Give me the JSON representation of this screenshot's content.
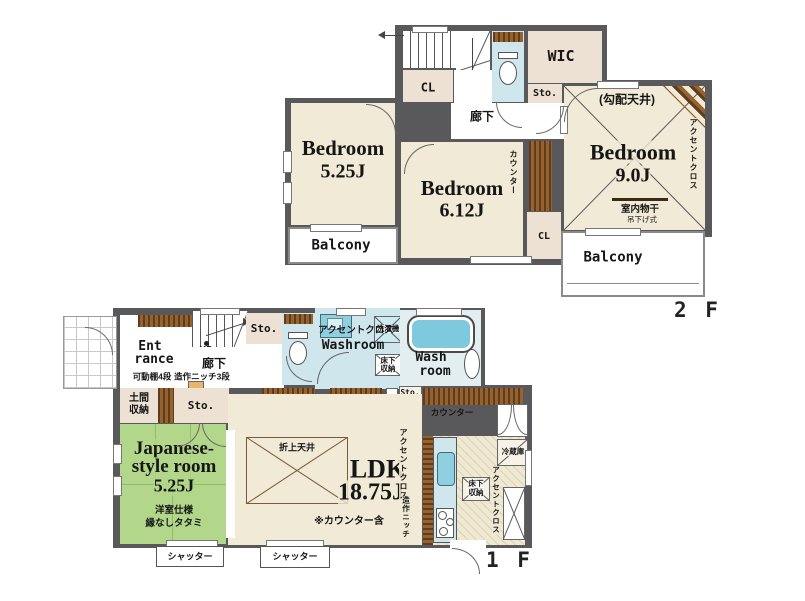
{
  "floor2": {
    "label": "2 F",
    "bed1_name": "Bedroom",
    "bed1_size": "5.25J",
    "bed2_name": "Bedroom",
    "bed2_size": "6.12J",
    "bed3_name": "Bedroom",
    "bed3_size": "9.0J",
    "sloped_ceiling": "(勾配天井)",
    "accent_cloth": "アクセントクロス",
    "indoor_drying": "室内物干",
    "hanging_type": "吊下げ式",
    "wic": "WIC",
    "sto": "Sto.",
    "cl_upper": "CL",
    "cl_lower": "CL",
    "corridor": "廊下",
    "counter": "カウンター",
    "dn": "DN",
    "balcony_left": "Balcony",
    "balcony_right": "Balcony"
  },
  "floor1": {
    "label": "1 F",
    "entrance_l1": "Ent",
    "entrance_l2": "rance",
    "up": "UP",
    "corridor": "廊下",
    "shelf_a": "可動棚4段",
    "niche_a": "造作ニッチ3段",
    "doma_l1": "土間",
    "doma_l2": "収納",
    "sto_top": "Sto.",
    "sto_mid": "Sto.",
    "sto_small": "Sto.",
    "counter_left": "カウンター",
    "counter_right": "カウンター",
    "accent_wash": "アクセントクロス",
    "washroom": "Washroom",
    "washer": "洗濯機",
    "underfloor_l1": "床下",
    "underfloor_l2": "収納",
    "bath_l1": "Wash",
    "bath_l2": "room",
    "shelf_b": "可動棚4段",
    "ps": "PS",
    "japanese_l1": "Japanese-",
    "japanese_l2": "style room",
    "japanese_size": "5.25J",
    "tatami_note1": "洋室仕様",
    "tatami_note2": "縁なしタタミ",
    "coffered": "折上天井",
    "ldk_name": "LDK",
    "ldk_size": "18.75J",
    "counter_note": "※カウンター含",
    "accent_ldk": "アクセントクロス",
    "niche_b": "造作ニッチ",
    "accent_kitchen": "アクセントクロス",
    "fridge": "冷蔵庫",
    "shutter_left": "シャッター",
    "shutter_right": "シャッター"
  },
  "colors": {
    "wall": "#59595b",
    "room_cream": "#f1ead7",
    "closet": "#ece1d3",
    "wet_blue": "#cfe7ec",
    "tatami_green": "#b3d78a",
    "wood_brown": "#96632f",
    "tub_blue": "#7fc9de"
  }
}
